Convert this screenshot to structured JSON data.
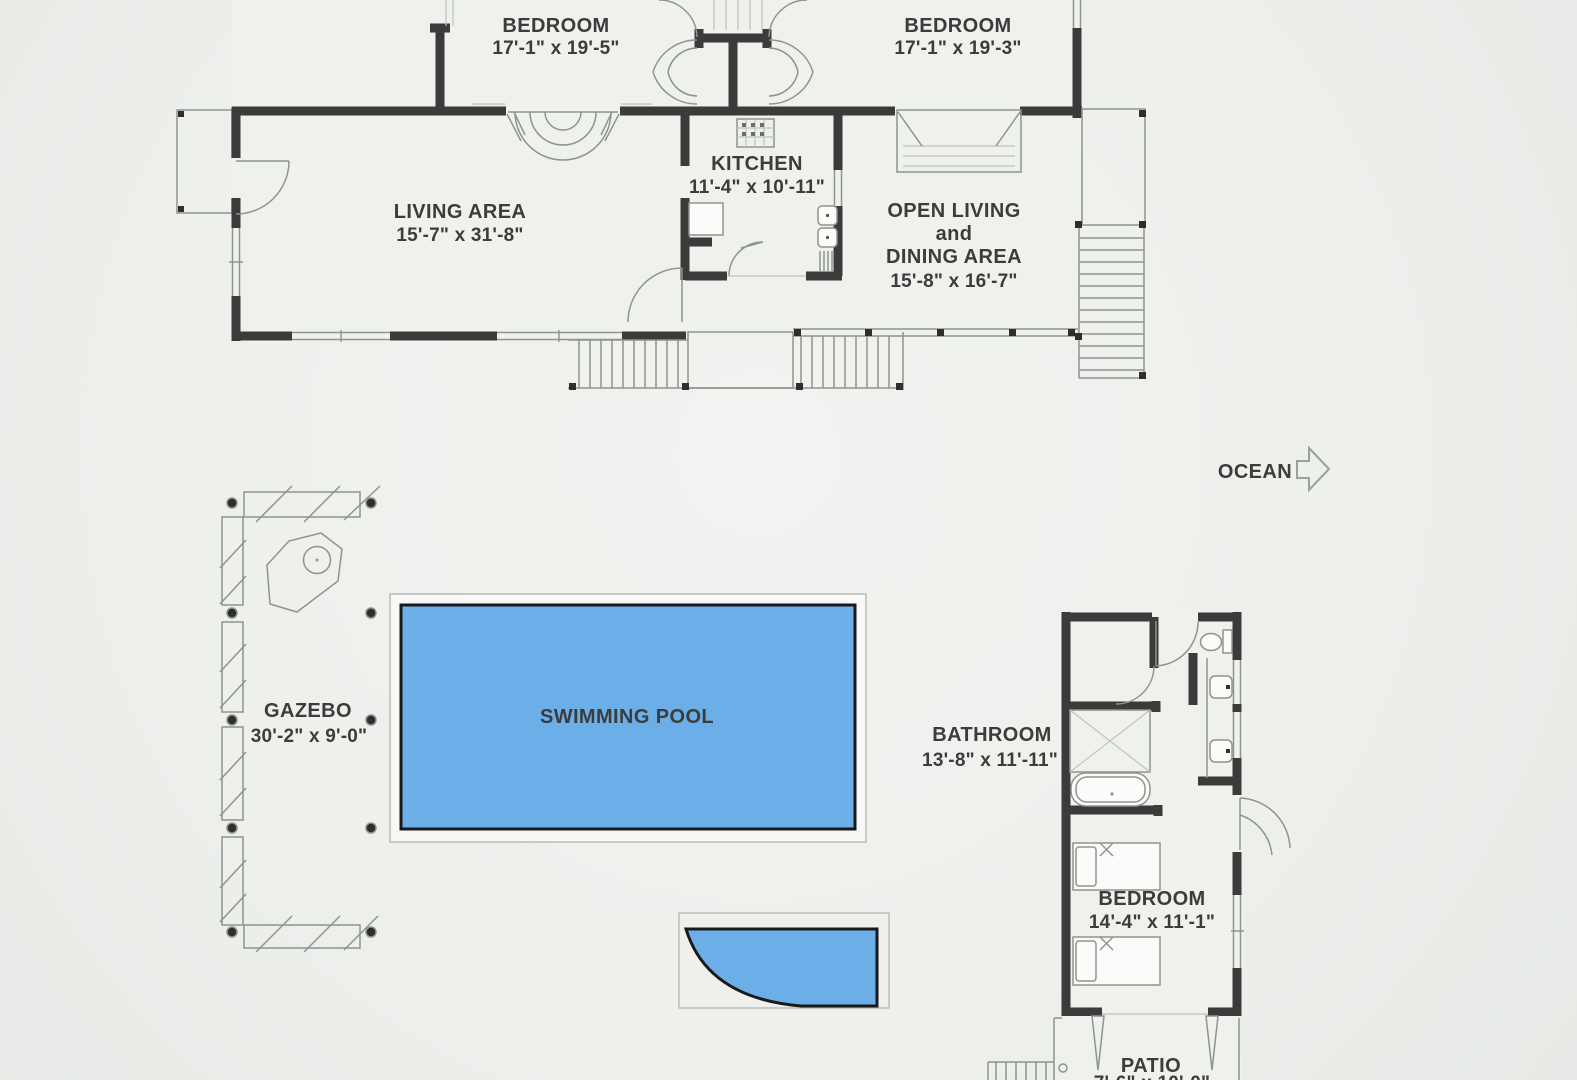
{
  "rooms": {
    "bedroom_left": {
      "name": "BEDROOM",
      "dims": "17'-1\" x 19'-5\""
    },
    "bedroom_right": {
      "name": "BEDROOM",
      "dims": "17'-1\" x 19'-3\""
    },
    "living_area": {
      "name": "LIVING AREA",
      "dims": "15'-7\" x 31'-8\""
    },
    "kitchen": {
      "name": "KITCHEN",
      "dims": "11'-4\" x 10'-11\""
    },
    "open_living": {
      "line1": "OPEN LIVING",
      "line2": "and",
      "line3": "DINING AREA",
      "dims": "15'-8\" x 16'-7\""
    },
    "gazebo": {
      "name": "GAZEBO",
      "dims": "30'-2\" x 9'-0\""
    },
    "swimming_pool": {
      "name": "SWIMMING POOL"
    },
    "bathroom": {
      "name": "BATHROOM",
      "dims": "13'-8\" x 11'-11\""
    },
    "bedroom_guest": {
      "name": "BEDROOM",
      "dims": "14'-4\" x 11'-1\""
    },
    "patio": {
      "name": "PATIO",
      "dims": "7'-6\" x 10'-0\""
    }
  },
  "annotations": {
    "ocean": "OCEAN"
  },
  "colors": {
    "background": "#eef0ec",
    "wall": "#3b3b3b",
    "line_gray": "#8f948f",
    "pool_fill": "#6cafe8",
    "pool_border": "#191919",
    "text": "#3c3c3c"
  }
}
